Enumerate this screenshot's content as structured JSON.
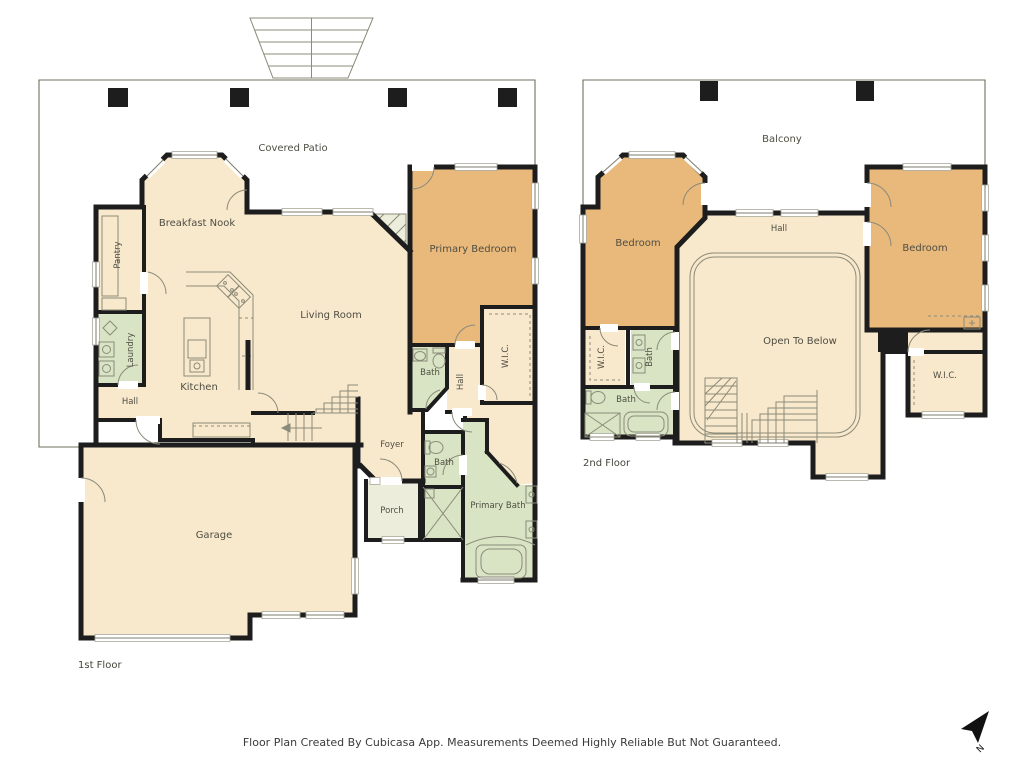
{
  "footer": {
    "disclaimer": "Floor Plan Created By Cubicasa App. Measurements Deemed Highly Reliable But Not Guaranteed."
  },
  "compass": {
    "north_label": "N"
  },
  "colors": {
    "wall": "#1d1d1d",
    "outdoor": "#ecedda",
    "interior": "#f8e8cc",
    "bedroom": "#e9b97c",
    "bath": "#d9e4c4",
    "fixture_line": "#8b8b7a",
    "label_text": "#4f4e43"
  },
  "floors": [
    {
      "label": "1st Floor",
      "rooms": {
        "covered_patio": "Covered Patio",
        "breakfast_nook": "Breakfast Nook",
        "pantry": "Pantry",
        "laundry": "Laundry",
        "hall": "Hall",
        "kitchen": "Kitchen",
        "living_room": "Living Room",
        "primary_bedroom": "Primary Bedroom",
        "bath_upper": "Bath",
        "hall_vertical": "Hall",
        "wic": "W.I.C.",
        "foyer": "Foyer",
        "bath_lower": "Bath",
        "primary_bath": "Primary Bath",
        "porch": "Porch",
        "garage": "Garage"
      }
    },
    {
      "label": "2nd Floor",
      "rooms": {
        "balcony": "Balcony",
        "bedroom_left": "Bedroom",
        "hall": "Hall",
        "bedroom_right": "Bedroom",
        "wic_left": "W.I.C.",
        "bath_vertical": "Bath",
        "bath_lower": "Bath",
        "open_to_below": "Open To Below",
        "wic_right": "W.I.C."
      }
    }
  ]
}
